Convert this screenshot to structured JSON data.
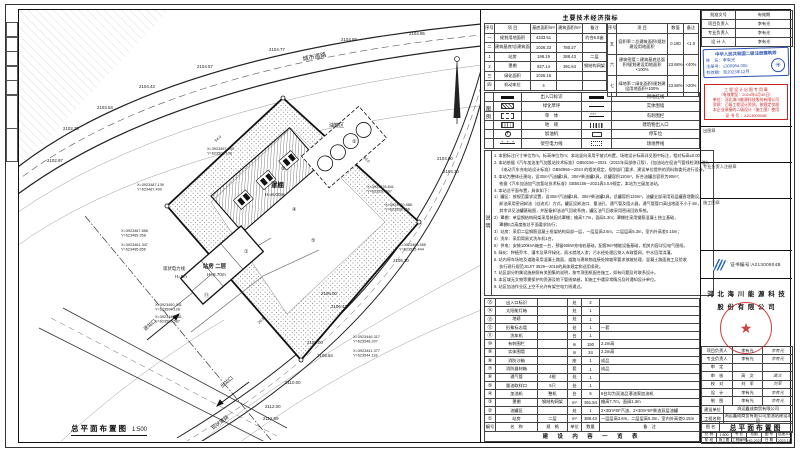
{
  "sheet": {
    "plan_title": "总平面布置图",
    "plan_scale": "1:500",
    "econ_title": "主要技术经济指标",
    "legend_strip": "图例",
    "notes_strip": "说明",
    "content_title": "建 设 内 容 一 览 表"
  },
  "econ_table": {
    "headers": [
      "序号",
      "项  目",
      "基底面积/m²",
      "建筑面积/m²",
      "备注"
    ],
    "left_rows": [
      [
        "一",
        "规划用地面积",
        "4333.51",
        "",
        "约合6.5亩"
      ],
      [
        "二",
        "建筑基底/总建筑面积",
        "1026.33",
        "780.27",
        ""
      ],
      [
        "1",
        "站房",
        "198.19",
        "388.43",
        "二层"
      ],
      [
        "2",
        "罩棚",
        "827.14",
        "391.84",
        "钢结构网架"
      ],
      [
        "三",
        "绿化面积",
        "1026.16",
        "",
        ""
      ],
      [
        "四",
        "机动车位",
        "4",
        "",
        ""
      ]
    ],
    "right_headers": [
      "序号",
      "项  目",
      "数值",
      "备注"
    ],
    "right_rows": [
      [
        "五",
        "容积率＝总建筑面积/规划建设用地面积",
        "0.180",
        "<1.0"
      ],
      [
        "六",
        "建筑密度＝建筑基底总面积/规划建设用地面积×100%",
        "23.68%",
        "<40%"
      ],
      [
        "七",
        "绿地率＝绿化面积/规划建设用地面积×100%",
        "23.68%",
        ">20%"
      ]
    ]
  },
  "legend": {
    "rows": [
      {
        "ls": "entry-bar",
        "ln": "出入口标识",
        "rs": "thick-line",
        "rn": "用地红线"
      },
      {
        "ls": "hatch-box",
        "ln": "绿化草坪",
        "rs": "thin-line",
        "rn": "实体围墙"
      },
      {
        "ls": "dash-box",
        "ln": "单　体",
        "rs": "barb-line",
        "rn": "有刺围栏"
      },
      {
        "ls": "grid-box",
        "ln": "地　磅",
        "rs": "hatch-bar",
        "rn": "建筑物出入口"
      },
      {
        "ls": "circle-plus",
        "ln": "加油机",
        "rs": "small-rect",
        "rn": "停车位"
      },
      {
        "ls": "power-line",
        "ln": "架空电力线",
        "rs": "dot-dash-box",
        "rn": "场地界线"
      }
    ]
  },
  "notes": {
    "lines": [
      "1. 本图标注尺寸单位为m，标高单位为m；本站竖向采用平坡式布置，场地设计标高详见图中标注，相对标高±0.00。",
      "2. 本站依据《汽车加油加气加氢站技术标准》GB50156—2021（2021年局部修订版）、《加油站在役油气管线检测标准》、",
      "　  《电动汽车充电站设计标准》GB50966—2024 的相关规定，规划部门要求、建设单位提供的资料和委托进行设计。",
      "3. 本站为整体迁建站，设30m³汽油罐2具、30m³柴油罐2具，总罐容积120m³，折合油罐总容积为90m³；",
      "　  依据《汽车加油加气加氢站技术标准》GB50156—2021表3.0.9规定，本站为三级加油站。",
      "4. 本站总平面布置，具体如下：",
      "1）罐区：按规范要求设置，设30m³汽油罐2具、30m³柴油罐2具，总罐容积120m³，油罐全部采用双层罐直埋敷设，",
      "　  卸油采用密闭卸油（自流式）方式，罐区设卸油口、量油孔、通气管及阻火器，通气管管口高出地面不小于4m，",
      "　  其余详见油罐基础图，并配备卸油油气回收系统，罐区油气回收采用密闭回收系统。",
      "2）罩棚：单层钢结构网架采用装配式罩棚；檐高7.7m，面阔1.3m；罩棚柱采用钢筋混凝土独立基础，",
      "　  罩棚E点高度按总平面要求执行；",
      "3）站房：采用二层钢筋混凝土框架结构局部一层，一层层高3.6m，二层层高5.3m，室内外高差0.15m；",
      "4）洗车：采用简易式洗车机1台。",
      "5）供电：安装100kVA箱变一台，预留60kW充电桩基础，配套9m²储能设备基础，相关内容详见电气图纸。",
      "5. 绿化：种植乔木、灌木及草坪绿化，雨水就地入渗；污水经处理后排入市政管网，中水回用浇灌。",
      "6. 站内停车场地及道路采用混凝土路面，道路与建筑物连接处按坡率要求放坡处理，混凝土路面施工及验收",
      "　  执行现行规范JGJ/T 3529—2016的具体规定和适用条款。",
      "7. 站区部分附属设施参照有关图集的说明，按专项图纸配合施工，如有问题及时联系设计。",
      "8. 本区域无文物等需保护的资源及地下管线穿越，如施工中遇异常情况及时通知设计单位。",
      "9. 站区加油作业区上空不允许有架空电力线通过。"
    ]
  },
  "content_table": {
    "rows": [
      [
        "⑮",
        "出入口标识",
        "",
        "处",
        "2",
        ""
      ],
      [
        "⑭",
        "太阳能灯箱",
        "",
        "处",
        "1",
        ""
      ],
      [
        "⑬",
        "地磅",
        "",
        "处",
        "1",
        ""
      ],
      [
        "⑫",
        "形象标志墙",
        "",
        "处",
        "1",
        "一套"
      ],
      [
        "⑪",
        "洗车机",
        "",
        "台",
        "1",
        ""
      ],
      [
        "⑩",
        "有刺围栏",
        "",
        "m",
        "150",
        "2.2m高"
      ],
      [
        "⑨",
        "实体围墙",
        "",
        "m",
        "34",
        "2.2m高"
      ],
      [
        "⑧",
        "消防沙箱",
        "",
        "座",
        "1",
        "成品"
      ],
      [
        "⑦",
        "消防器材箱",
        "",
        "套",
        "1",
        "成品"
      ],
      [
        "⑥",
        "通气管",
        "4根",
        "处",
        "1",
        ""
      ],
      [
        "⑤",
        "量油取样口",
        "5只",
        "处",
        "1",
        ""
      ],
      [
        "④",
        "加油机",
        "整机",
        "台",
        "6",
        "6台均为双油品潜油泵加油机"
      ],
      [
        "③",
        "罩棚",
        "钢结构网架",
        "m²",
        "391.84",
        "檐高7.7m，面阔1.3m"
      ],
      [
        "②",
        "油罐区",
        "",
        "处",
        "1",
        "2×30m³SF汽油、2×30m³SF柴油双层油罐"
      ],
      [
        "①",
        "站房",
        "二层",
        "m²",
        "388.43",
        "一层层高3.6m，二层层高5.3m，室内外高差0.15m"
      ]
    ],
    "headers": [
      "编号",
      "名　称",
      "规　格",
      "单位",
      "数量",
      "备　注"
    ]
  },
  "title_block": {
    "approval": {
      "c1": "批准文号",
      "c2": "有效期",
      "rows": [
        [
          "项目负责人",
          "李有光"
        ],
        [
          "专业负责人",
          "李有光"
        ],
        [
          "设 计 人",
          "李有光"
        ]
      ]
    },
    "blue_stamp": {
      "title": "中华人民共和国二级注册建筑师",
      "name": "姓　名：李有光",
      "no": "注册号：1300984-005",
      "valid": "有效期：至2023年12月",
      "seal_glyph": "✳"
    },
    "red_stamp": {
      "lines": [
        "工 程 设 计 出 图 专 用 章",
        "（有效期至：2024年4月30日）",
        "单位：河北海川能源科技股份有限公司",
        "资质：乙级工程设计资质，按规定仅限",
        "本企业承接的二级设计（施工图）使用",
        "证 书 号 ：A21300904B"
      ]
    },
    "box_labels": [
      "出图章",
      "专业负责人注册章",
      "施工图章"
    ],
    "cert_no": "证书编号:A21300904B",
    "company": [
      "河 北 海 川 能 源 科 技",
      "股 份 有 限 公 司"
    ],
    "seal_star": "★",
    "staff": [
      [
        "项目负责人",
        "李有光",
        "李有光"
      ],
      [
        "专业负责人",
        "李有光",
        "李有光"
      ],
      [
        "审　定",
        "",
        ""
      ],
      [
        "审　核",
        "高　文",
        "高文"
      ],
      [
        "校　对",
        "刘　军",
        "刘军"
      ],
      [
        "设　计",
        "李有光",
        "李有光"
      ],
      [
        "制　图",
        "李有光",
        "李有光"
      ]
    ],
    "project": [
      [
        "建设单位",
        "鸿运鑫成商贸有限公司"
      ],
      [
        "工程名称",
        "鸿运鑫成商贸有限公司加油站建设项目"
      ]
    ],
    "drawing": {
      "label": "图 名",
      "value": "总平面布置图"
    },
    "meta1": [
      [
        "比 例",
        "1:500"
      ],
      [
        "专 业",
        "总图"
      ],
      [
        "图 号",
        "总施-01"
      ]
    ],
    "meta2": [
      [
        "阶 段",
        "施工图"
      ],
      [
        "工程编号",
        "HQ-2023-12"
      ],
      [
        "日 期",
        "2023.11"
      ]
    ]
  },
  "site_plan": {
    "labels": [
      {
        "t": "2102.30",
        "x": 44,
        "y": 120,
        "s": 4.4
      },
      {
        "t": "2102.97",
        "x": 28,
        "y": 152,
        "s": 4.4
      },
      {
        "t": "2103.54",
        "x": 78,
        "y": 99,
        "s": 4.4
      },
      {
        "t": "2104.43",
        "x": 120,
        "y": 78,
        "s": 4.4
      },
      {
        "t": "2104.57",
        "x": 178,
        "y": 58,
        "s": 4.4
      },
      {
        "t": "2104.77",
        "x": 250,
        "y": 41,
        "s": 4.4
      },
      {
        "t": "2104.89",
        "x": 322,
        "y": 31,
        "s": 4.4
      },
      {
        "t": "2104.95",
        "x": 390,
        "y": 25,
        "s": 4.4
      },
      {
        "t": "2104.00",
        "x": 418,
        "y": 150,
        "s": 4.4
      },
      {
        "t": "2104.30",
        "x": 424,
        "y": 163,
        "s": 4.4
      },
      {
        "t": "2105.10",
        "x": 374,
        "y": 252,
        "s": 4.4
      },
      {
        "t": "2106.00",
        "x": 302,
        "y": 285,
        "s": 4.4
      },
      {
        "t": "2106.43",
        "x": 312,
        "y": 298,
        "s": 4.4
      },
      {
        "t": "2108.00",
        "x": 288,
        "y": 334,
        "s": 4.4
      },
      {
        "t": "2108.54",
        "x": 298,
        "y": 347,
        "s": 4.4
      },
      {
        "t": "2110.00",
        "x": 266,
        "y": 374,
        "s": 4.4
      },
      {
        "t": "2112.00",
        "x": 246,
        "y": 398,
        "s": 4.4
      },
      {
        "t": "2112.59",
        "x": 244,
        "y": 410,
        "s": 4.4
      },
      {
        "t": "罩棚",
        "x": 252,
        "y": 177,
        "s": 6.4,
        "w": "bold"
      },
      {
        "t": "H=8.00m",
        "x": 246,
        "y": 186,
        "s": 4.8
      },
      {
        "t": "站房 二层",
        "x": 184,
        "y": 258,
        "s": 5.4,
        "w": "bold"
      },
      {
        "t": "H=8.70m",
        "x": 188,
        "y": 266,
        "s": 4.6
      },
      {
        "t": "油罐区",
        "x": 310,
        "y": 117,
        "s": 5
      },
      {
        "t": "进站口",
        "x": 126,
        "y": 321,
        "s": 5,
        "r": -40
      },
      {
        "t": "出站口",
        "x": 203,
        "y": 378,
        "s": 5,
        "r": -40
      },
      {
        "t": "现状电力线",
        "x": 144,
        "y": 260,
        "s": 4.4
      },
      {
        "t": "H=8m",
        "x": 156,
        "y": 268,
        "s": 4.4
      },
      {
        "t": "城市道路",
        "x": 284,
        "y": 51,
        "s": 6,
        "r": -11
      },
      {
        "t": "现状道路",
        "x": 194,
        "y": 420,
        "s": 5,
        "r": -38
      },
      {
        "t": "③",
        "x": 262,
        "y": 160,
        "s": 5
      },
      {
        "t": "④",
        "x": 273,
        "y": 201,
        "s": 5
      },
      {
        "t": "①",
        "x": 225,
        "y": 243,
        "s": 5
      },
      {
        "t": "②",
        "x": 333,
        "y": 133,
        "s": 5
      },
      {
        "t": "⑤",
        "x": 292,
        "y": 232,
        "s": 5
      },
      {
        "t": "⑪",
        "x": 185,
        "y": 287,
        "s": 5
      },
      {
        "t": "80.0",
        "x": 344,
        "y": 148,
        "s": 3.8,
        "r": 42
      },
      {
        "t": "54.0",
        "x": 197,
        "y": 132,
        "s": 3.8,
        "r": -41
      },
      {
        "t": "26.5",
        "x": 240,
        "y": 314,
        "s": 3.8,
        "r": -41
      }
    ],
    "coords": [
      {
        "x": 118,
        "y": 176,
        "l1": "X=3923487.139",
        "l2": "Y=623487.490"
      },
      {
        "x": 188,
        "y": 140,
        "l1": "X=3923497.890",
        "l2": "Y=623509.108"
      },
      {
        "x": 348,
        "y": 178,
        "l1": "X=3923478.841",
        "l2": "Y=623520.667"
      },
      {
        "x": 366,
        "y": 196,
        "l1": "X=3923470.588",
        "l2": "Y=623528.966"
      },
      {
        "x": 380,
        "y": 236,
        "l1": "X=3923463.555",
        "l2": "Y=623535.444"
      },
      {
        "x": 334,
        "y": 328,
        "l1": "X=3923446.317",
        "l2": "Y=623548.207"
      },
      {
        "x": 334,
        "y": 342,
        "l1": "X=3923441.377",
        "l2": "Y=623544.118"
      },
      {
        "x": 102,
        "y": 222,
        "l1": "X=3923467.858",
        "l2": "Y=623489.358"
      },
      {
        "x": 102,
        "y": 236,
        "l1": "X=3923461.347",
        "l2": "Y=623485.856"
      },
      {
        "x": 136,
        "y": 296,
        "l1": "X=3923450.341",
        "l2": "Y=623500.128"
      },
      {
        "x": 136,
        "y": 308,
        "l1": "X=3923445.381",
        "l2": "Y=623505.587"
      }
    ]
  }
}
